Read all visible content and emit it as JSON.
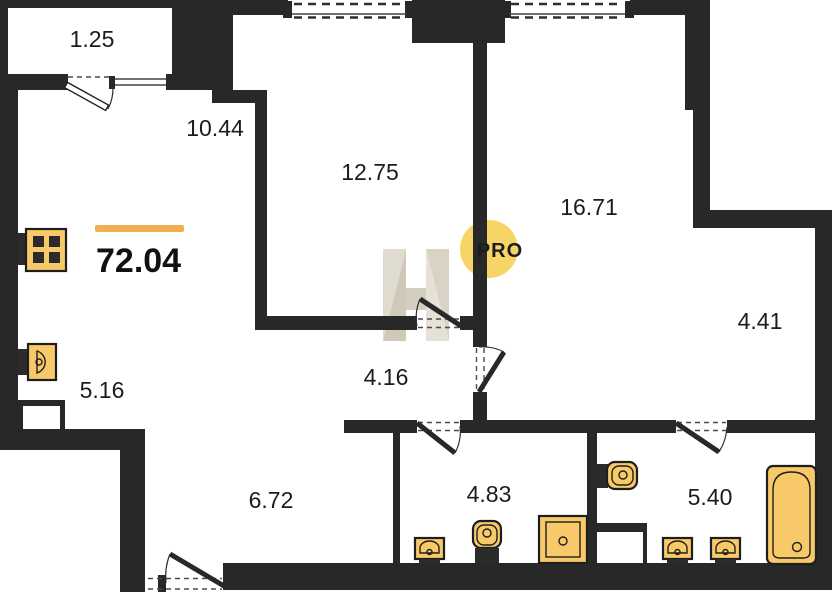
{
  "plan": {
    "type": "apartment-floor-plan",
    "total": {
      "area": "72.04"
    },
    "watermark": {
      "label": "PRO"
    },
    "rooms": [
      {
        "area": "1.25"
      },
      {
        "area": "10.44"
      },
      {
        "area": "12.75"
      },
      {
        "area": "16.71"
      },
      {
        "area": "4.41"
      },
      {
        "area": "4.16"
      },
      {
        "area": "5.16"
      },
      {
        "area": "6.72"
      },
      {
        "area": "4.83"
      },
      {
        "area": "5.40"
      }
    ],
    "colors": {
      "wall": "#282828",
      "fixture": "#f8c968",
      "fixture_dark": "#2b2b2b",
      "accent_bar": "#f0b052",
      "watermark_circle": "#f6d466",
      "watermark_text": "#a09f97",
      "watermark_h_light": "#e0dbcf",
      "watermark_h_dark": "#cfc9ba",
      "label_text": "#1c1c1c"
    },
    "icons": [
      "stove-icon",
      "kitchen-sink-icon",
      "toilet-icon",
      "washbasin-icon",
      "shower-tray-icon",
      "bathtub-icon",
      "door-swing",
      "window"
    ]
  }
}
